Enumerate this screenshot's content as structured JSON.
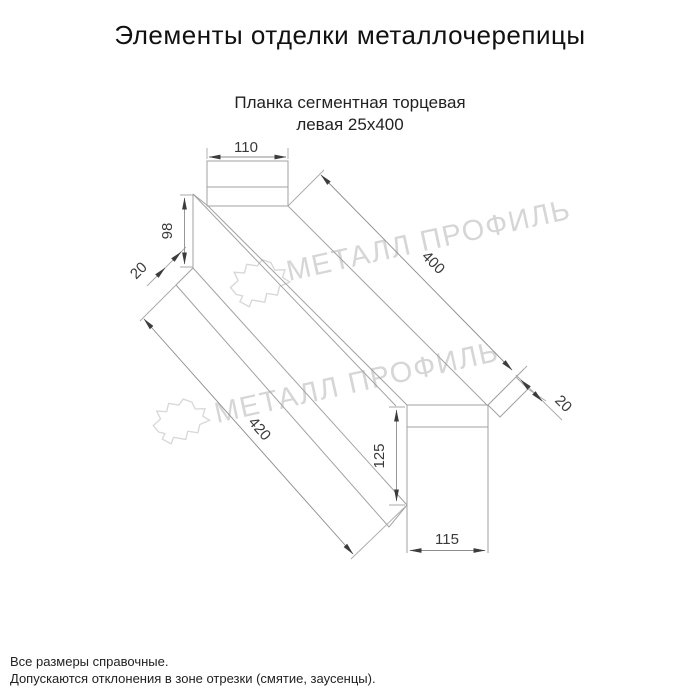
{
  "title": "Элементы отделки металлочерепицы",
  "subtitle": {
    "line1": "Планка сегментная торцевая",
    "line2": "левая 25x400"
  },
  "watermark": {
    "text": "МЕТАЛЛ ПРОФИЛЬ",
    "color": "#d6d6d6"
  },
  "drawing": {
    "part_name": "Планка сегментная торцевая левая",
    "line_color": "#a2a2a2",
    "dim_text_color": "#3a3a3a",
    "dims": {
      "w110": "110",
      "h98": "98",
      "lip20_left": "20",
      "len400": "400",
      "len420": "420",
      "lip20_right": "20",
      "h125": "125",
      "w115": "115"
    }
  },
  "footnotes": [
    "Все размеры справочные.",
    "Допускаются отклонения в зоне отрезки (смятие, заусенцы)."
  ]
}
